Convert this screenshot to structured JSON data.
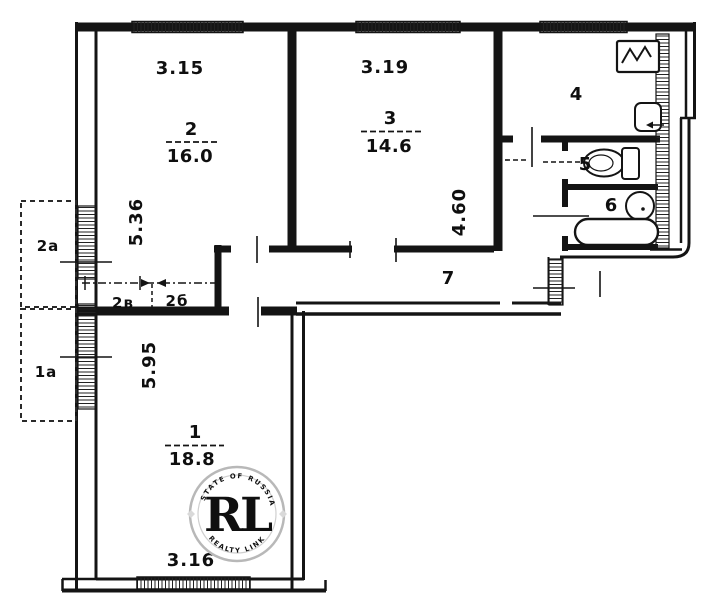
{
  "rooms": {
    "r1": {
      "number": "1",
      "area": "18.8"
    },
    "r2": {
      "number": "2",
      "area": "16.0"
    },
    "r3": {
      "number": "3",
      "area": "14.6"
    },
    "r4": {
      "number": "4"
    },
    "r5": {
      "number": "5"
    },
    "r6": {
      "number": "6"
    },
    "r7": {
      "number": "7"
    }
  },
  "dims": {
    "room2_width": "3.15",
    "room2_depth": "5.36",
    "room3_width": "3.19",
    "room3_depth": "4.60",
    "room1_depth": "5.95",
    "room1_width": "3.16"
  },
  "annexes": {
    "balcony_upper": "2а",
    "balcony_lower": "1а",
    "closet_left": "2в",
    "closet_right": "2б"
  },
  "watermark": {
    "monogram": "RL",
    "arc_top": "ESTATE OF RUSSIA",
    "arc_bottom": "REALTY LINK"
  },
  "colors": {
    "ink": "#141414",
    "gold": "#bf9b3e",
    "gold_light": "#d9b85c",
    "gold_dark": "#9c7a2e",
    "ring_gray": "#b8b8b8"
  }
}
